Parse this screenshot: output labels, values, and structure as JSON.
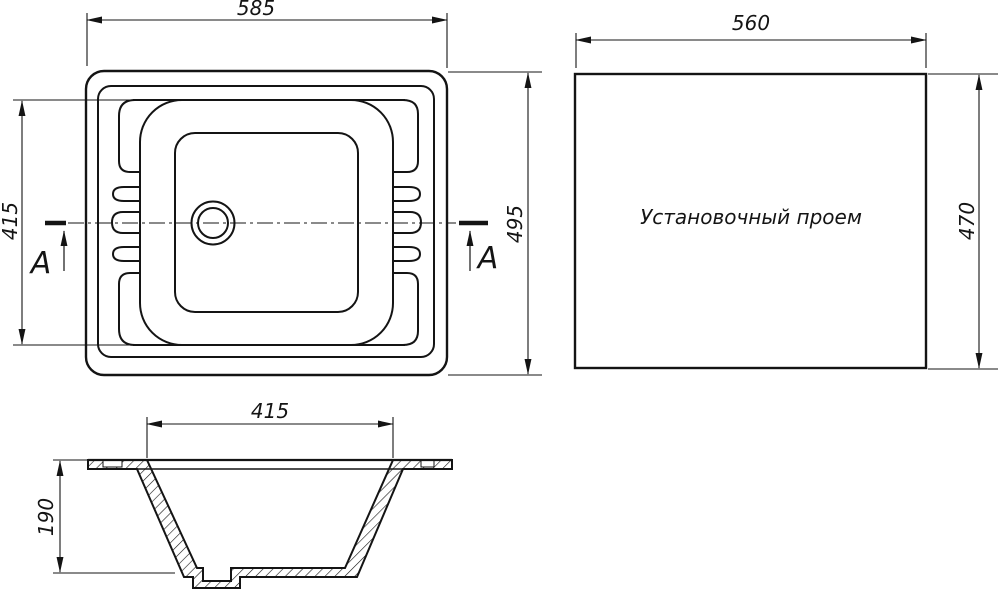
{
  "drawing": {
    "colors": {
      "line": "#141414",
      "background": "#ffffff"
    },
    "plan_view": {
      "width_dim": "585",
      "height_dim": "495",
      "bowl_width_dim": "415",
      "section_label_left": "A",
      "section_label_right": "A"
    },
    "opening_view": {
      "label": "Установочный проем",
      "width_dim": "560",
      "height_dim": "470"
    },
    "section_view": {
      "width_dim": "415",
      "depth_dim": "190"
    }
  }
}
